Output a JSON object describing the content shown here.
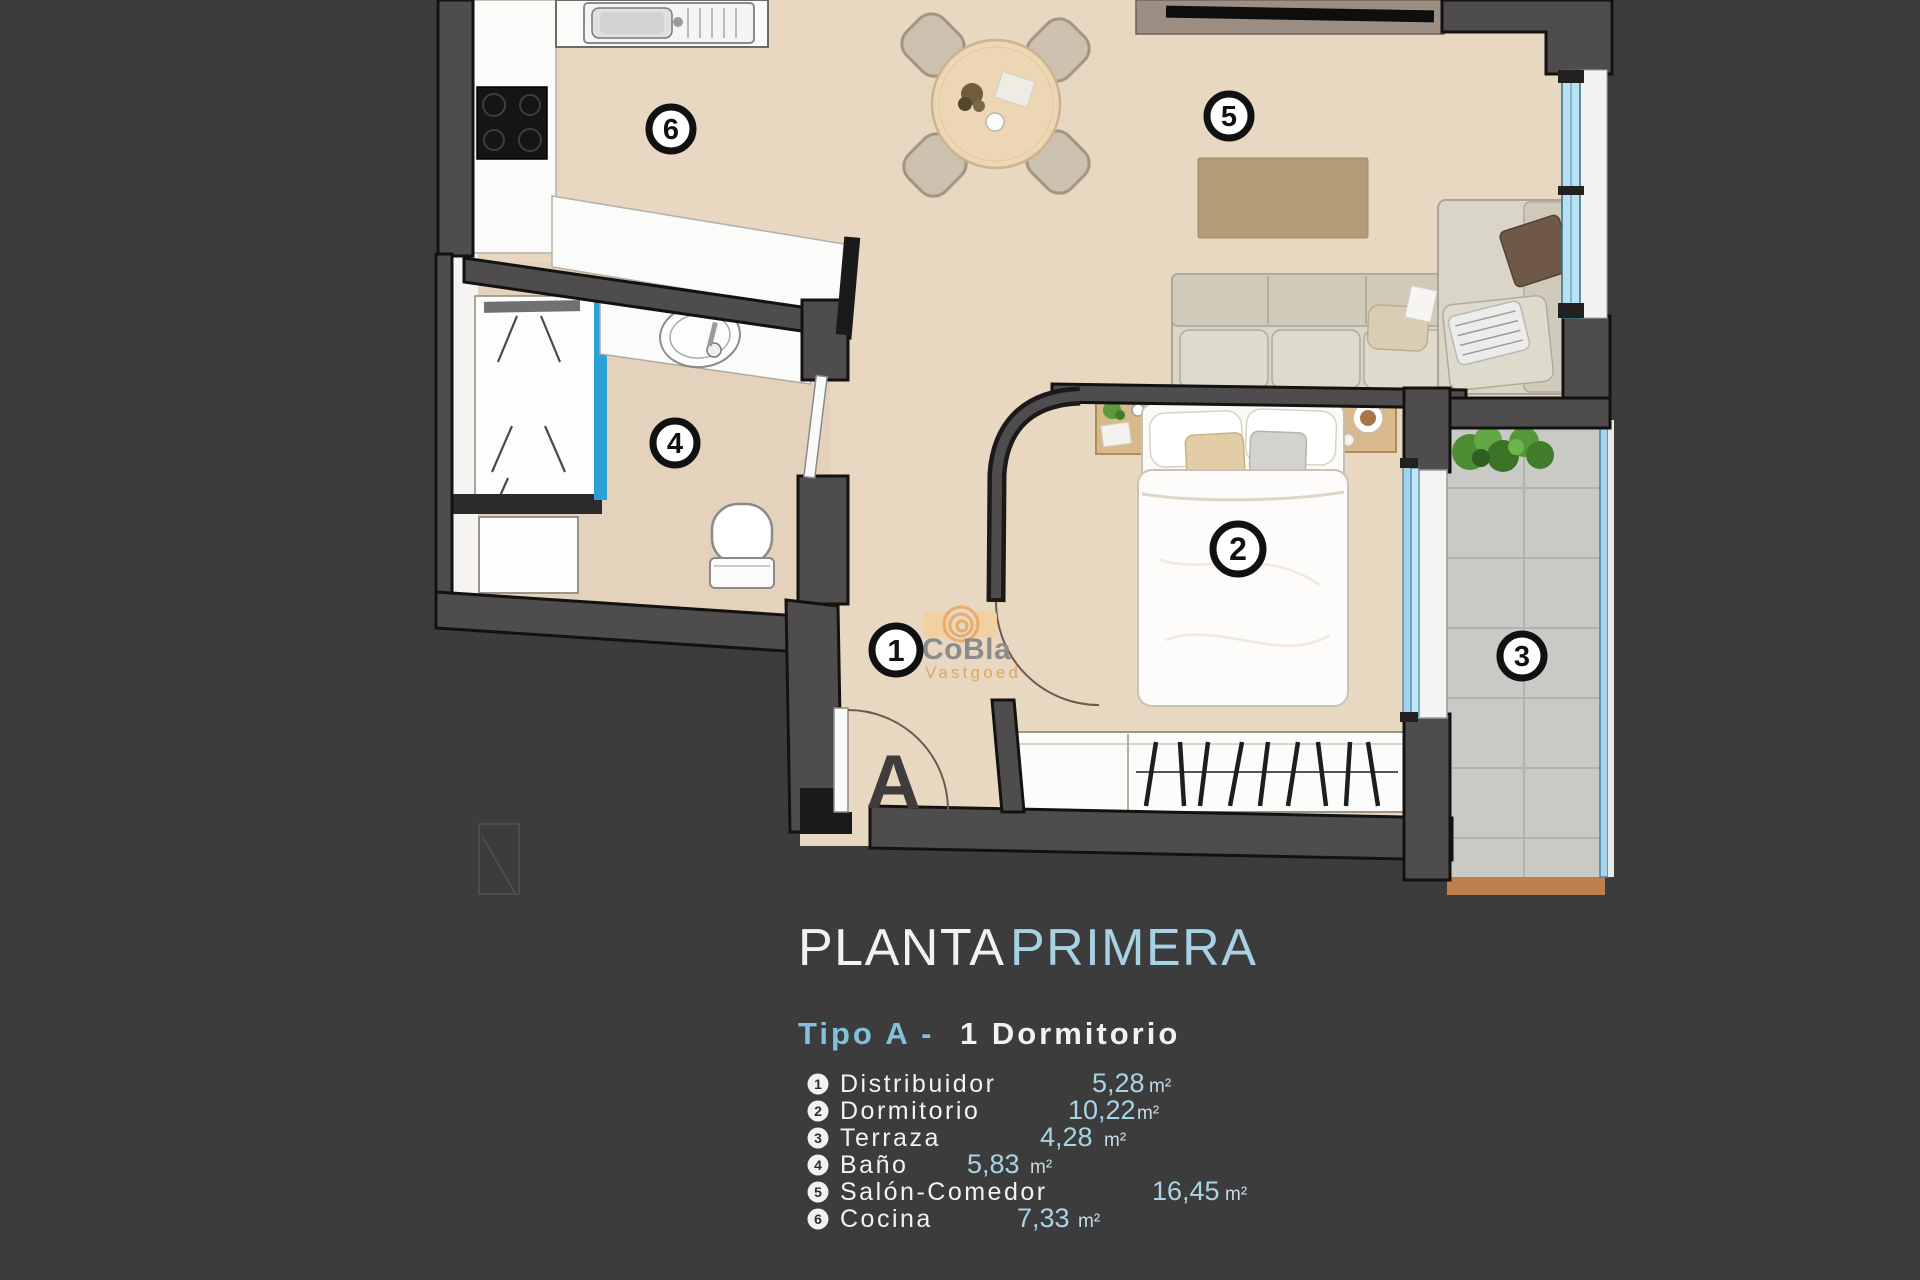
{
  "title": {
    "part1": "PLANTA",
    "part2": "PRIMERA"
  },
  "subtitle": {
    "left": "Tipo A -",
    "right": "1 Dormitorio"
  },
  "watermark": {
    "brand": "CoBla",
    "subtitle": "Vastgoed"
  },
  "entrance": {
    "label": "A"
  },
  "plan": {
    "markers": [
      {
        "num": "1",
        "room": "Distribuidor"
      },
      {
        "num": "2",
        "room": "Dormitorio"
      },
      {
        "num": "3",
        "room": "Terraza"
      },
      {
        "num": "4",
        "room": "Baño"
      },
      {
        "num": "5",
        "room": "Salón-Comedor"
      },
      {
        "num": "6",
        "room": "Cocina"
      }
    ]
  },
  "legend": {
    "items": [
      {
        "num": "1",
        "name": "Distribuidor",
        "area": "5,28",
        "unit": "m²"
      },
      {
        "num": "2",
        "name": "Dormitorio",
        "area": "10,22",
        "unit": "m²"
      },
      {
        "num": "3",
        "name": "Terraza",
        "area": "4,28",
        "unit": "m²"
      },
      {
        "num": "4",
        "name": "Baño",
        "area": "5,83",
        "unit": "m²"
      },
      {
        "num": "5",
        "name": "Salón-Comedor",
        "area": "16,45",
        "unit": "m²"
      },
      {
        "num": "6",
        "name": "Cocina",
        "area": "7,33",
        "unit": "m²"
      }
    ]
  },
  "colors": {
    "background": "#3d3c3c",
    "accent_blue": "#a6d2e4",
    "text_white": "#f2f2f2",
    "floor_beige": "#e8d7c1",
    "wall_gray": "#4e4c4c",
    "glass_blue": "#b7e0f2",
    "shower_glass_blue": "#2da0d8",
    "terrace_tile": "#c9c9c6",
    "terrace_edge": "#c0804e",
    "rug_tan": "#b49a77",
    "watermark_orange": "#e5a55f"
  }
}
